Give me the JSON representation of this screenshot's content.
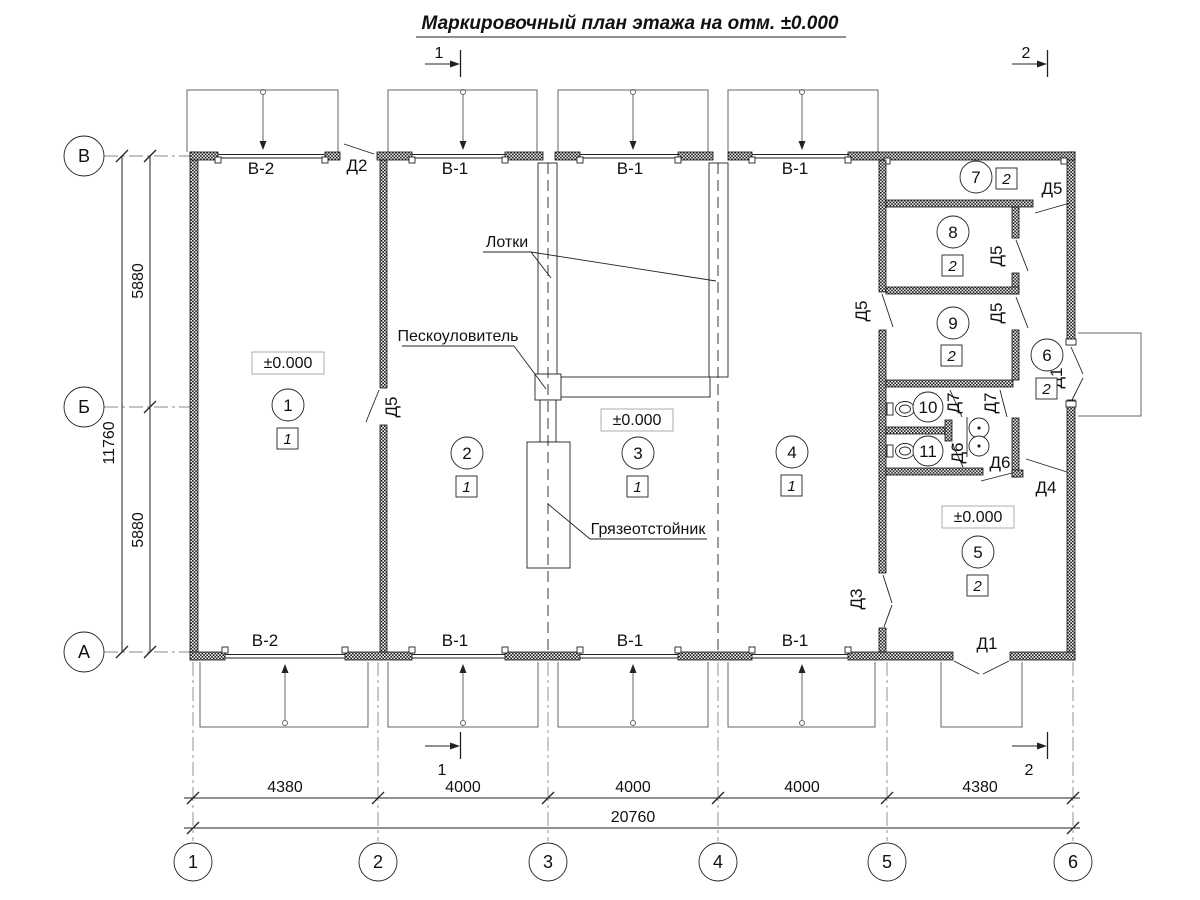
{
  "title": "Маркировочный план этажа на отм. ±0.000",
  "sections": {
    "mark1": "1",
    "mark2": "2"
  },
  "row_axes": [
    "В",
    "Б",
    "А"
  ],
  "col_axes": [
    "1",
    "2",
    "3",
    "4",
    "5",
    "6"
  ],
  "dimensions": {
    "bottom_spans": [
      "4380",
      "4000",
      "4000",
      "4000",
      "4380"
    ],
    "bottom_total": "20760",
    "left_spans": [
      "5880",
      "5880"
    ],
    "left_total": "11760"
  },
  "labels": {
    "v1": "В-1",
    "v2": "В-2",
    "d1": "Д1",
    "d2": "Д2",
    "d3": "Д3",
    "d4": "Д4",
    "d5": "Д5",
    "d6": "Д6",
    "d7": "Д7",
    "elevation": "±0.000"
  },
  "annotations": {
    "trays": "Лотки",
    "sand_trap": "Пескоуловитель",
    "mud_settler": "Грязеотстойник"
  },
  "rooms": [
    {
      "num": "1",
      "type": "1"
    },
    {
      "num": "2",
      "type": "1"
    },
    {
      "num": "3",
      "type": "1"
    },
    {
      "num": "4",
      "type": "1"
    },
    {
      "num": "5",
      "type": "2"
    },
    {
      "num": "6",
      "type": "2"
    },
    {
      "num": "7",
      "type": "2"
    },
    {
      "num": "8",
      "type": "2"
    },
    {
      "num": "9",
      "type": "2"
    },
    {
      "num": "10"
    },
    {
      "num": "11"
    }
  ]
}
